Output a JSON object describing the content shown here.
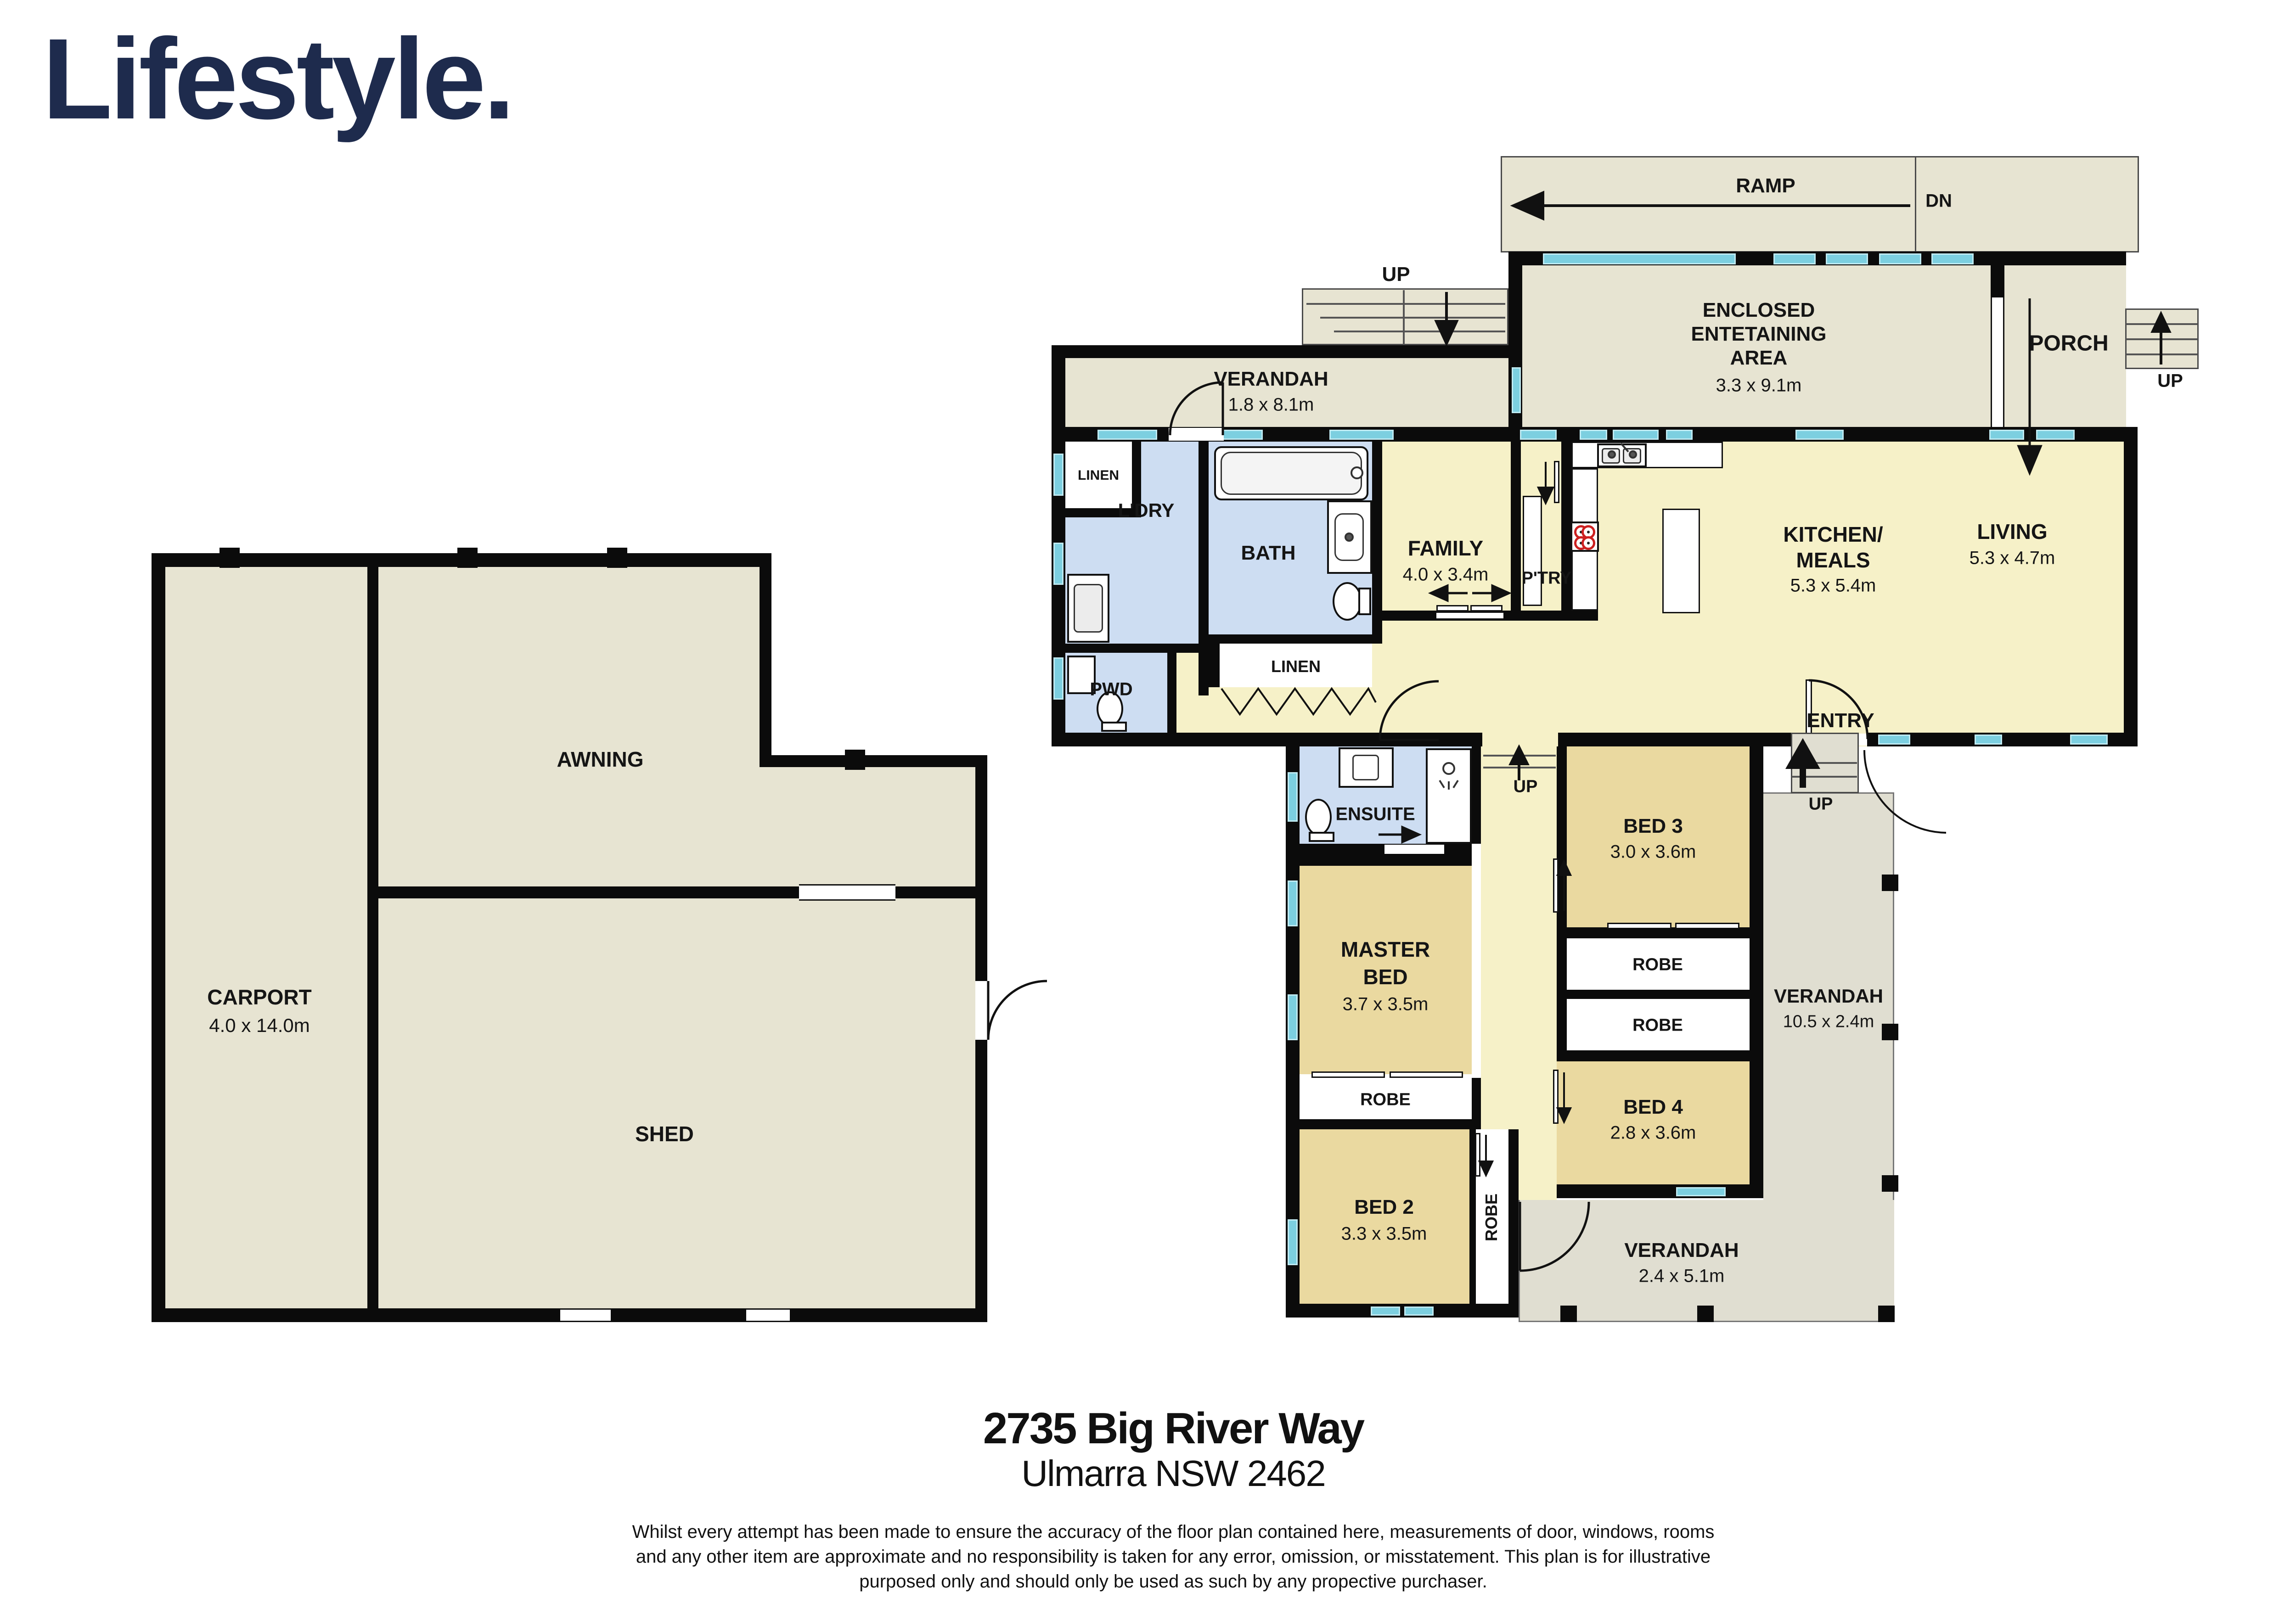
{
  "brand": {
    "logo": "Lifestyle."
  },
  "address": {
    "line1": "2735 Big River Way",
    "line2": "Ulmarra NSW 2462"
  },
  "disclaimer": {
    "line1": "Whilst every attempt has been made to ensure the accuracy of the floor plan contained here, measurements of door, windows, rooms",
    "line2": "and any other item are approximate and no responsibility is taken for any error, omission, or misstatement. This plan is for illustrative",
    "line3": "purposed only and should only be used as such by any propective purchaser."
  },
  "outbuilding": {
    "carport": {
      "name": "CARPORT",
      "dims": "4.0 x 14.0m"
    },
    "awning": {
      "name": "AWNING"
    },
    "shed": {
      "name": "SHED"
    }
  },
  "house": {
    "ramp": {
      "name": "RAMP",
      "down": "DN"
    },
    "porch": {
      "name": "PORCH",
      "up": "UP"
    },
    "verandah_top": {
      "name": "VERANDAH",
      "dims": "1.8 x 8.1m",
      "up": "UP"
    },
    "enclosed": {
      "line1": "ENCLOSED",
      "line2": "ENTETAINING",
      "line3": "AREA",
      "dims": "3.3 x 9.1m"
    },
    "linen_top": {
      "name": "LINEN"
    },
    "laundry": {
      "name": "L'DRY"
    },
    "bath": {
      "name": "BATH"
    },
    "linen_mid": {
      "name": "LINEN"
    },
    "pwd": {
      "name": "PWD"
    },
    "family": {
      "name": "FAMILY",
      "dims": "4.0 x 3.4m"
    },
    "pantry": {
      "name": "P'TRY"
    },
    "kitchen": {
      "line1": "KITCHEN/",
      "line2": "MEALS",
      "dims": "5.3 x 5.4m"
    },
    "living": {
      "name": "LIVING",
      "dims": "5.3 x 4.7m"
    },
    "entry": {
      "name": "ENTRY",
      "up": "UP"
    },
    "hall": {
      "up": "UP"
    },
    "ensuite": {
      "name": "ENSUITE"
    },
    "bed3": {
      "name": "BED 3",
      "dims": "3.0 x 3.6m"
    },
    "master": {
      "line1": "MASTER",
      "line2": "BED",
      "dims": "3.7 x 3.5m"
    },
    "robe_master": {
      "name": "ROBE"
    },
    "bed2": {
      "name": "BED 2",
      "dims": "3.3 x 3.5m"
    },
    "robe_bed2": {
      "name": "ROBE"
    },
    "robe_a": {
      "name": "ROBE"
    },
    "robe_b": {
      "name": "ROBE"
    },
    "bed4": {
      "name": "BED 4",
      "dims": "2.8 x 3.6m"
    },
    "verandah_right": {
      "name": "VERANDAH",
      "dims": "10.5 x 2.4m"
    },
    "verandah_bottom": {
      "name": "VERANDAH",
      "dims": "2.4 x 5.1m"
    }
  },
  "colors": {
    "wall": "#0b0b0b",
    "outdoor_beige": "#e7e4d2",
    "verandah_gray": "#e0ded1",
    "living_cream": "#f6f1c8",
    "bedroom_tan": "#ead9a0",
    "wet_blue": "#cdddf2",
    "window_cyan": "#7ccfe0",
    "logo_navy": "#1e2b4d"
  }
}
